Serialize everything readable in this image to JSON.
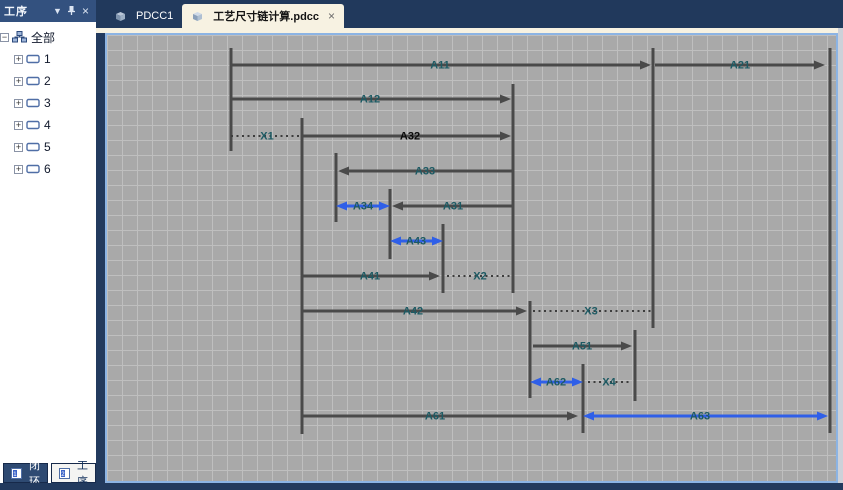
{
  "doc_tabs": [
    {
      "label": "PDCC1",
      "icon": "pdcc-document-icon",
      "active": false
    },
    {
      "label": "工艺尺寸链计算.pdcc",
      "icon": "pdcc-document-icon",
      "active": true,
      "close": "×"
    }
  ],
  "sidebar": {
    "title": "工序",
    "header_icons": {
      "dropdown": "▼",
      "pin": "pin-icon",
      "close": "×"
    },
    "tree": {
      "root": {
        "label": "全部",
        "expander": "−",
        "icon": "org-chart-icon"
      },
      "items": [
        {
          "label": "1",
          "expander": "+",
          "icon": "operation-icon"
        },
        {
          "label": "2",
          "expander": "+",
          "icon": "operation-icon"
        },
        {
          "label": "3",
          "expander": "+",
          "icon": "operation-icon"
        },
        {
          "label": "4",
          "expander": "+",
          "icon": "operation-icon"
        },
        {
          "label": "5",
          "expander": "+",
          "icon": "operation-icon"
        },
        {
          "label": "6",
          "expander": "+",
          "icon": "operation-icon"
        }
      ]
    },
    "bottom_tabs": [
      {
        "label": "闭环",
        "icon": "loop-tab-icon",
        "active": false
      },
      {
        "label": "工序",
        "icon": "operation-tab-icon",
        "active": true
      }
    ]
  },
  "colors": {
    "dim_line": "#4a4a4a",
    "dim_blue": "#2f5fe8",
    "dotted": "#3d3d3d",
    "label_teal": "#1d5a63",
    "label_emphasis": "#0a0a0a",
    "canvas_bg": "#a9a9a9",
    "grid_line": "#bfbfbf",
    "frame_navy": "#223a5e",
    "tab_cream": "#f7f2e2",
    "canvas_border_blue": "#8cb4e4"
  },
  "diagram": {
    "grid_px": 15,
    "canvas_size": {
      "w": 729,
      "h": 446
    },
    "vlines": [
      {
        "x": 124,
        "y1": 13,
        "y2": 116
      },
      {
        "x": 195,
        "y1": 83,
        "y2": 399
      },
      {
        "x": 229,
        "y1": 118,
        "y2": 187
      },
      {
        "x": 283,
        "y1": 154,
        "y2": 224
      },
      {
        "x": 336,
        "y1": 189,
        "y2": 258
      },
      {
        "x": 406,
        "y1": 49,
        "y2": 258
      },
      {
        "x": 423,
        "y1": 266,
        "y2": 363
      },
      {
        "x": 476,
        "y1": 329,
        "y2": 398
      },
      {
        "x": 528,
        "y1": 295,
        "y2": 366
      },
      {
        "x": 546,
        "y1": 13,
        "y2": 293
      },
      {
        "x": 723,
        "y1": 13,
        "y2": 398
      }
    ],
    "dims": [
      {
        "label": "A11",
        "y": 30,
        "x1": 124,
        "x2": 544,
        "arrows": "right",
        "style": "solid",
        "color": "dark",
        "label_x": 333
      },
      {
        "label": "A21",
        "y": 30,
        "x1": 548,
        "x2": 718,
        "arrows": "right",
        "style": "solid",
        "color": "dark",
        "label_x": 633
      },
      {
        "label": "A12",
        "y": 64,
        "x1": 124,
        "x2": 404,
        "arrows": "right",
        "style": "solid",
        "color": "dark",
        "label_x": 263
      },
      {
        "label": "X1",
        "y": 101,
        "x1": 124,
        "x2": 195,
        "arrows": "none",
        "style": "dotted",
        "color": "dark",
        "label_x": 160
      },
      {
        "label": "A32",
        "y": 101,
        "x1": 195,
        "x2": 404,
        "arrows": "right",
        "style": "solid",
        "color": "dark",
        "label_x": 303,
        "emphasis": true
      },
      {
        "label": "A33",
        "y": 136,
        "x1": 231,
        "x2": 406,
        "arrows": "left",
        "style": "solid",
        "color": "dark",
        "label_x": 318
      },
      {
        "label": "A34",
        "y": 171,
        "x1": 229,
        "x2": 283,
        "arrows": "both",
        "style": "solid",
        "color": "blue",
        "label_x": 256
      },
      {
        "label": "A31",
        "y": 171,
        "x1": 285,
        "x2": 406,
        "arrows": "left",
        "style": "solid",
        "color": "dark",
        "label_x": 346
      },
      {
        "label": "A43",
        "y": 206,
        "x1": 283,
        "x2": 336,
        "arrows": "both",
        "style": "solid",
        "color": "blue",
        "label_x": 309
      },
      {
        "label": "A41",
        "y": 241,
        "x1": 195,
        "x2": 333,
        "arrows": "right",
        "style": "solid",
        "color": "dark",
        "label_x": 263
      },
      {
        "label": "X2",
        "y": 241,
        "x1": 340,
        "x2": 405,
        "arrows": "none",
        "style": "dotted",
        "color": "dark",
        "label_x": 373
      },
      {
        "label": "A42",
        "y": 276,
        "x1": 195,
        "x2": 420,
        "arrows": "right",
        "style": "solid",
        "color": "dark",
        "label_x": 306
      },
      {
        "label": "X3",
        "y": 276,
        "x1": 426,
        "x2": 545,
        "arrows": "none",
        "style": "dotted",
        "color": "dark",
        "label_x": 484
      },
      {
        "label": "A51",
        "y": 311,
        "x1": 426,
        "x2": 525,
        "arrows": "right",
        "style": "solid",
        "color": "dark",
        "label_x": 475
      },
      {
        "label": "A62",
        "y": 347,
        "x1": 423,
        "x2": 476,
        "arrows": "both",
        "style": "solid",
        "color": "blue",
        "label_x": 449
      },
      {
        "label": "X4",
        "y": 347,
        "x1": 481,
        "x2": 525,
        "arrows": "none",
        "style": "dotted",
        "color": "dark",
        "label_x": 502
      },
      {
        "label": "A61",
        "y": 381,
        "x1": 195,
        "x2": 471,
        "arrows": "right",
        "style": "solid",
        "color": "dark",
        "label_x": 328
      },
      {
        "label": "A63",
        "y": 381,
        "x1": 476,
        "x2": 721,
        "arrows": "both",
        "style": "solid",
        "color": "blue",
        "label_x": 593
      }
    ]
  }
}
